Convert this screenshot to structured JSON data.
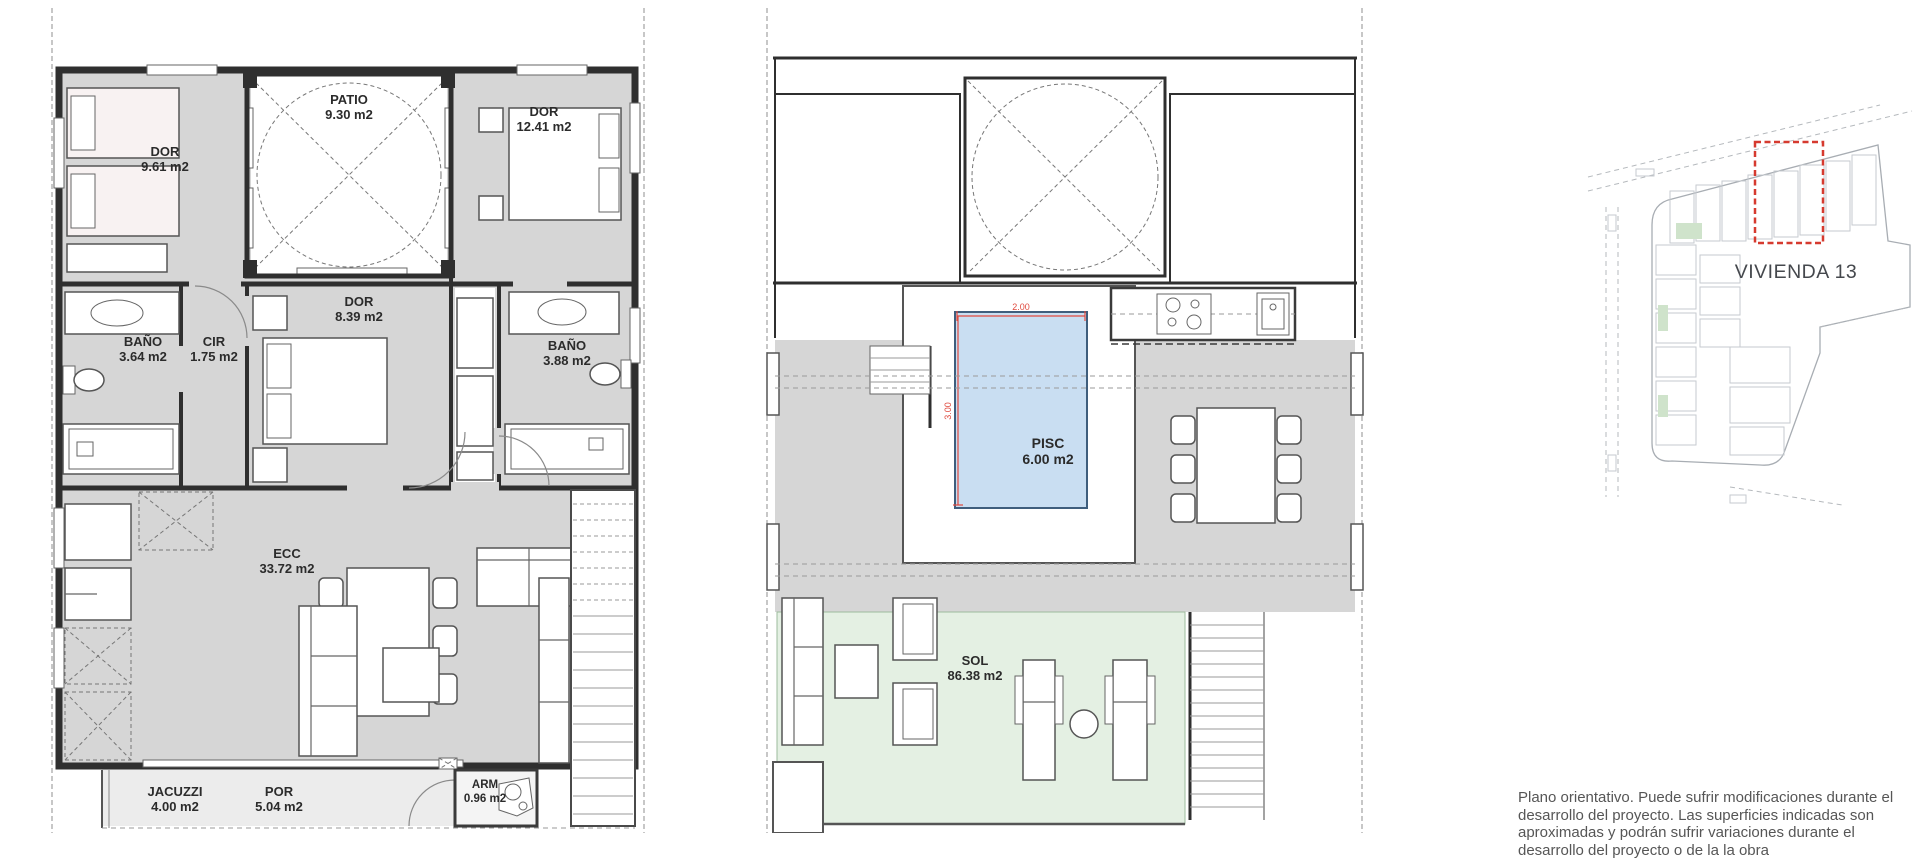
{
  "colors": {
    "floor": "#d6d6d6",
    "wall": "#2f2f2f",
    "pool": "#c9def2",
    "solarium": "#e4f0e3",
    "porch": "#ececec",
    "dimension_red": "#e04a3f",
    "highlight_red": "#d63a2f",
    "site_line": "#a8adb3",
    "label_text": "#2b2b2b"
  },
  "plan1": {
    "rooms": {
      "dor1": {
        "name": "DOR",
        "area": "9.61 m2"
      },
      "patio": {
        "name": "PATIO",
        "area": "9.30 m2"
      },
      "dor2": {
        "name": "DOR",
        "area": "12.41 m2"
      },
      "dor3": {
        "name": "DOR",
        "area": "8.39 m2"
      },
      "bano1": {
        "name": "BAÑO",
        "area": "3.64 m2"
      },
      "cir": {
        "name": "CIR",
        "area": "1.75 m2"
      },
      "bano2": {
        "name": "BAÑO",
        "area": "3.88 m2"
      },
      "ecc": {
        "name": "ECC",
        "area": "33.72 m2"
      },
      "jacuzzi": {
        "name": "JACUZZI",
        "area": "4.00 m2"
      },
      "por": {
        "name": "POR",
        "area": "5.04 m2"
      },
      "arm": {
        "name": "ARM",
        "area": "0.96 m2"
      }
    }
  },
  "plan2": {
    "rooms": {
      "pisc": {
        "name": "PISC",
        "area": "6.00 m2"
      },
      "sol": {
        "name": "SOL",
        "area": "86.38 m2"
      }
    },
    "dims": {
      "width": "2.00",
      "height": "3.00"
    }
  },
  "site_plan": {
    "label": "VIVIENDA 13"
  },
  "disclaimer": {
    "text": "Plano orientativo. Puede sufrir modificaciones durante el desarrollo del proyecto. Las superficies indicadas son aproximadas y podrán sufrir variaciones durante el desarrollo del proyecto o de la la obra"
  }
}
